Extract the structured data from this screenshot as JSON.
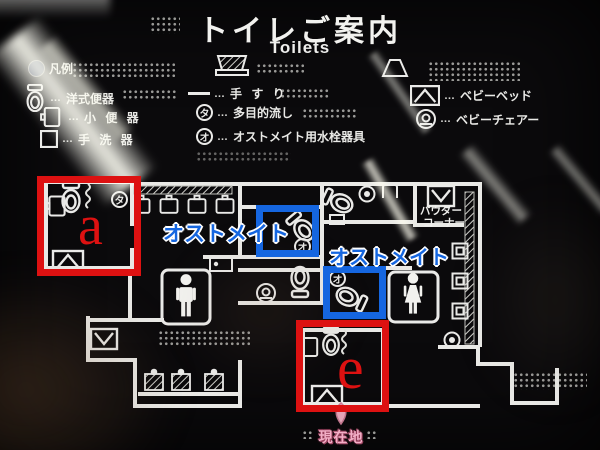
{
  "title": {
    "ja": "トイレご案内",
    "en": "Toilets"
  },
  "legend": {
    "heading": "凡例",
    "leader": "…",
    "items_left": [
      {
        "name": "western-toilet",
        "label": "洋式便器"
      },
      {
        "name": "urinal",
        "label": "小 便 器"
      },
      {
        "name": "hand-wash-basin",
        "label": "手 洗 器"
      }
    ],
    "items_middle": [
      {
        "name": "handrail",
        "label": "手 す り"
      },
      {
        "name": "multipurpose-sink",
        "badge": "タ",
        "label": "多目的流し"
      },
      {
        "name": "ostomate-fixture",
        "badge": "オ",
        "label": "オストメイト用水栓器具"
      }
    ],
    "items_right": [
      {
        "name": "baby-bed",
        "label": "ベビーベッド"
      },
      {
        "name": "baby-chair",
        "label": "ベビーチェアー"
      }
    ]
  },
  "map": {
    "powder_line1": "パウダー",
    "powder_line2": "コーナー",
    "you_are_here": "現在地",
    "badge_ta": "タ",
    "badge_o": "オ"
  },
  "annotations": {
    "letter_a": "a",
    "letter_e": "e",
    "ostomate_1": "オストメイト",
    "ostomate_2": "オストメイト",
    "red_color": "#dd1111",
    "blue_color": "#1566e0",
    "line_color": "#e9e9e6",
    "marker_pink": "#f2aec6"
  }
}
